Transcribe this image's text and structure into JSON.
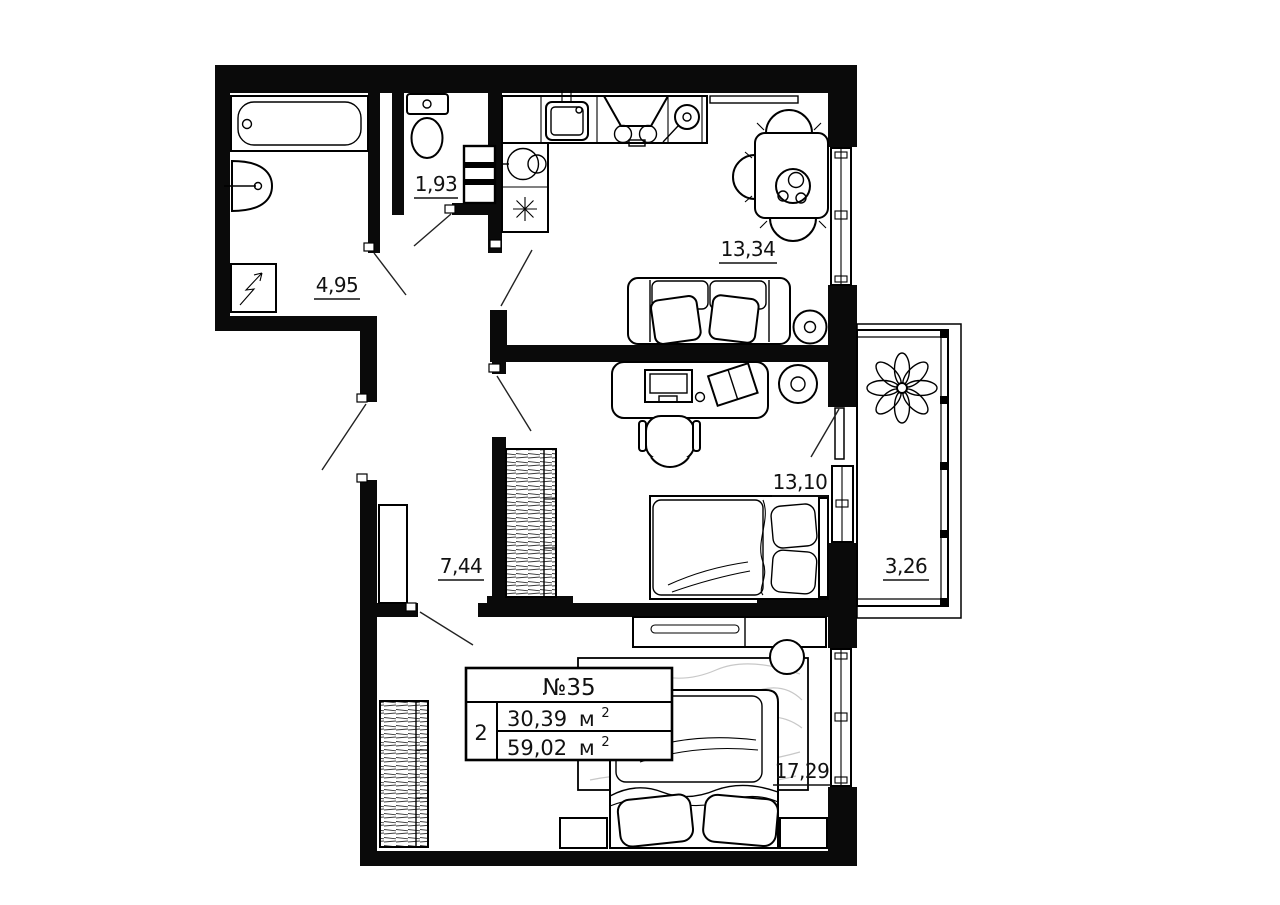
{
  "plan": {
    "rooms": {
      "bathroom": {
        "area": "4,95"
      },
      "toilet": {
        "area": "1,93"
      },
      "kitchen_living": {
        "area": "13,34"
      },
      "bedroom": {
        "area": "13,10"
      },
      "hallway": {
        "area": "7,44"
      },
      "balcony": {
        "area": "3,26"
      },
      "master_bedroom": {
        "area": "17,29"
      }
    },
    "stamp": {
      "number": "№35",
      "room_count": "2",
      "living_area": "30,39",
      "total_area": "59,02",
      "area_unit": "м",
      "area_unit_exp": "2"
    },
    "icons": {
      "refrigerator": "asterisk",
      "electrical_panel": "lightning-arrow",
      "balcony_plant": "flower"
    },
    "colors": {
      "walls": "#0a0a0a",
      "background": "#ffffff",
      "lines": "#000000",
      "rug_texture": "#c8c8c8"
    }
  }
}
